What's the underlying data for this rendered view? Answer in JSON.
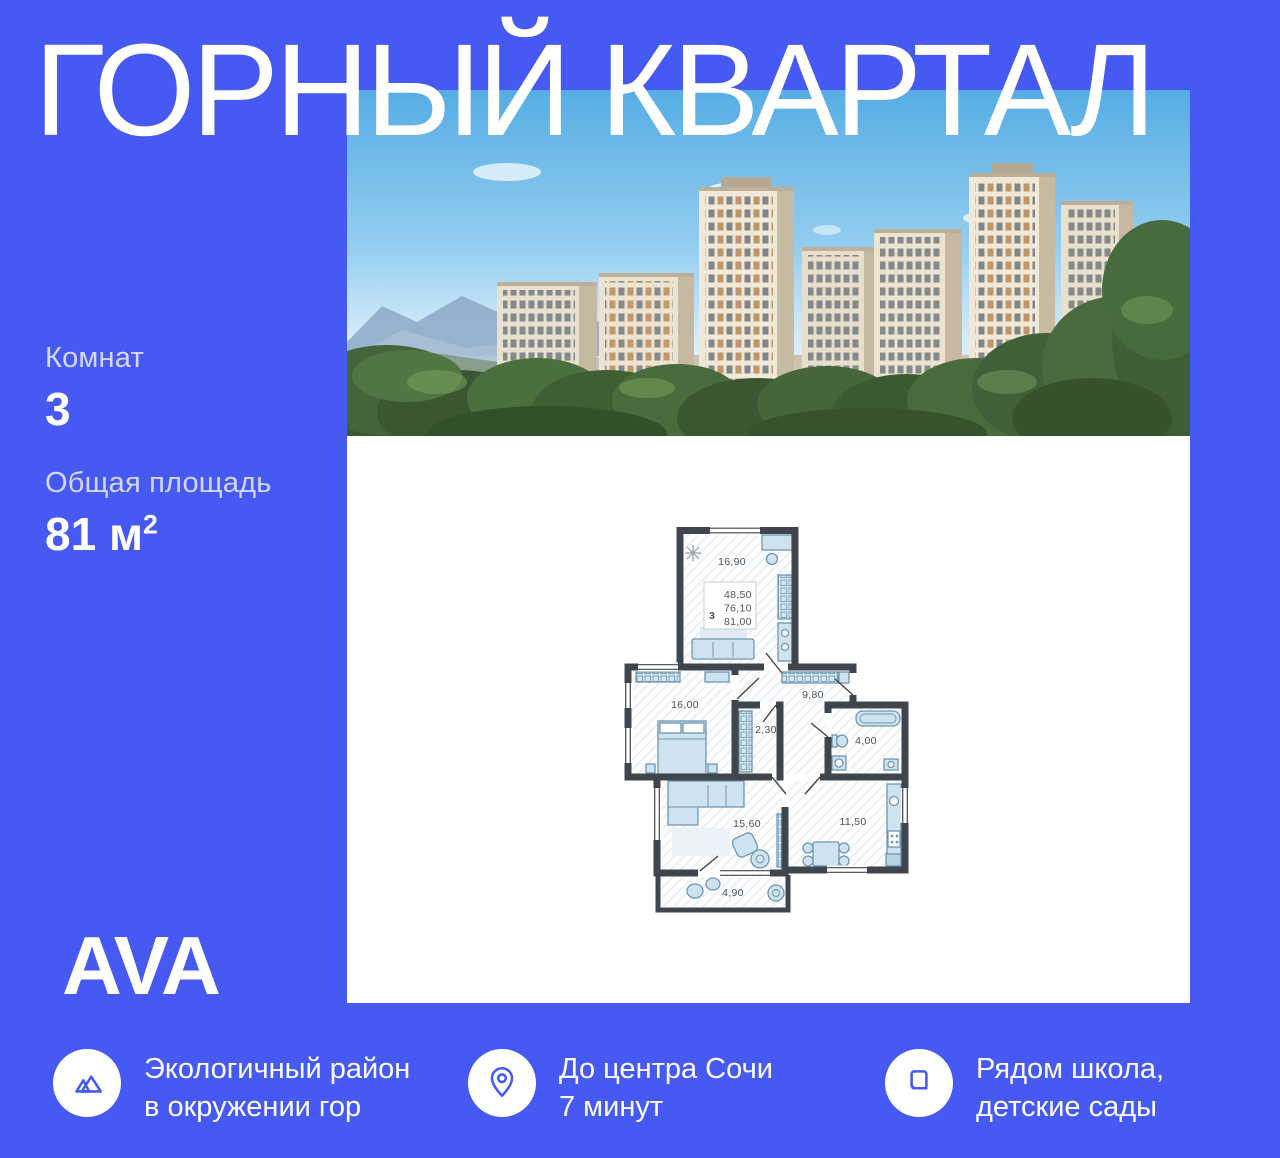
{
  "colors": {
    "accent_blue": "#4659F2",
    "panel_white": "#FFFFFF",
    "plan_wall": "#3F454C",
    "plan_furniture": "#CFE2F0"
  },
  "title": "ГОРНЫЙ КВАРТАЛ",
  "specs": [
    {
      "label": "Комнат",
      "value": "3"
    },
    {
      "label": "Общая площадь",
      "value": "81 м",
      "sup": "2"
    }
  ],
  "logo": "AVA",
  "features": [
    {
      "icon": "mountains-icon",
      "line1": "Экологичный район",
      "line2": "в окружении гор"
    },
    {
      "icon": "location-pin-icon",
      "line1": "До центра Сочи",
      "line2": "7 минут"
    },
    {
      "icon": "book-icon",
      "line1": "Рядом школа,",
      "line2": "детские сады"
    }
  ],
  "floor_plan": {
    "summary": {
      "rooms": "3",
      "areas": [
        "48,50",
        "76,10",
        "81,00"
      ]
    },
    "rooms": [
      {
        "name": "living-kitchen",
        "area": "16,90"
      },
      {
        "name": "bedroom",
        "area": "16,00"
      },
      {
        "name": "wardrobe",
        "area": "2,30"
      },
      {
        "name": "hallway",
        "area": "9,80"
      },
      {
        "name": "bathroom",
        "area": "4,00"
      },
      {
        "name": "living-room",
        "area": "15,60"
      },
      {
        "name": "kitchen",
        "area": "11,50"
      },
      {
        "name": "balcony",
        "area": "4,90"
      }
    ]
  }
}
